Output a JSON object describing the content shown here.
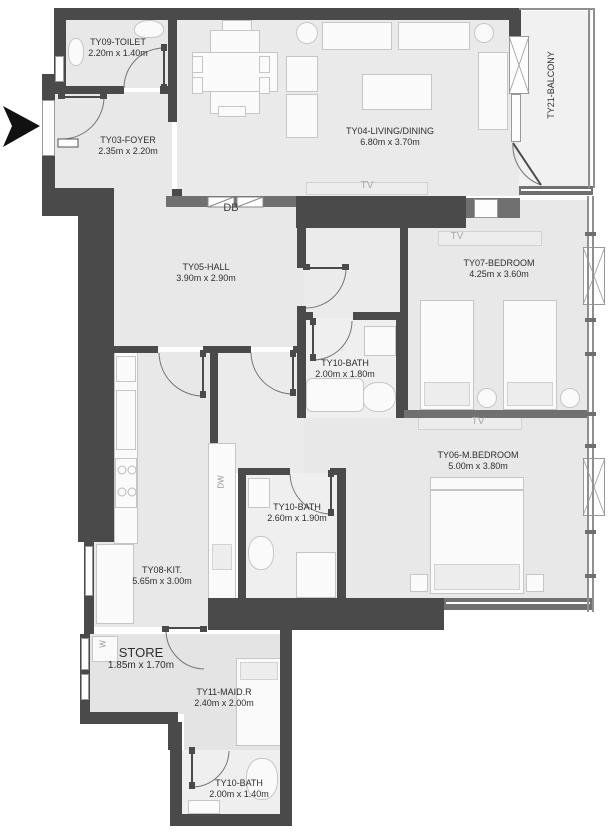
{
  "plan_title": "Apartment floor plan",
  "rooms": [
    {
      "name": "TY09-TOILET",
      "dims": "2.20m x 1.40m"
    },
    {
      "name": "TY03-FOYER",
      "dims": "2.35m x 2.20m"
    },
    {
      "name": "TY04-LIVING/DINING",
      "dims": "6.80m x 3.70m"
    },
    {
      "name": "TY21-BALCONY",
      "dims": ""
    },
    {
      "name": "TY05-HALL",
      "dims": "3.90m x 2.90m"
    },
    {
      "name": "TY07-BEDROOM",
      "dims": "4.25m x 3.60m"
    },
    {
      "name": "TY10-BATH",
      "dims": "2.00m x 1.80m"
    },
    {
      "name": "TY06-M.BEDROOM",
      "dims": "5.00m x 3.80m"
    },
    {
      "name": "TY10-BATH",
      "dims": "2.60m x 1.90m"
    },
    {
      "name": "TY08-KIT.",
      "dims": "5.65m x 3.00m"
    },
    {
      "name": "STORE",
      "dims": "1.85m x 1.70m"
    },
    {
      "name": "TY11-MAID.R",
      "dims": "2.40m x 2.00m"
    },
    {
      "name": "TY10-BATH",
      "dims": "2.00m x 1.40m"
    }
  ],
  "annotations": {
    "db": "DB",
    "tv": "TV",
    "dw": "DW",
    "w": "W"
  },
  "colors": {
    "wall_dark": "#4a4a4a",
    "wall_medium": "#707070",
    "floor": "#e8e8e8",
    "floor_wet": "#efefef",
    "floor_balcony": "#f1f1f1",
    "furniture_fill": "#fafafa",
    "furniture_line": "#c6c6c6",
    "entry_arrow": "#111111"
  }
}
